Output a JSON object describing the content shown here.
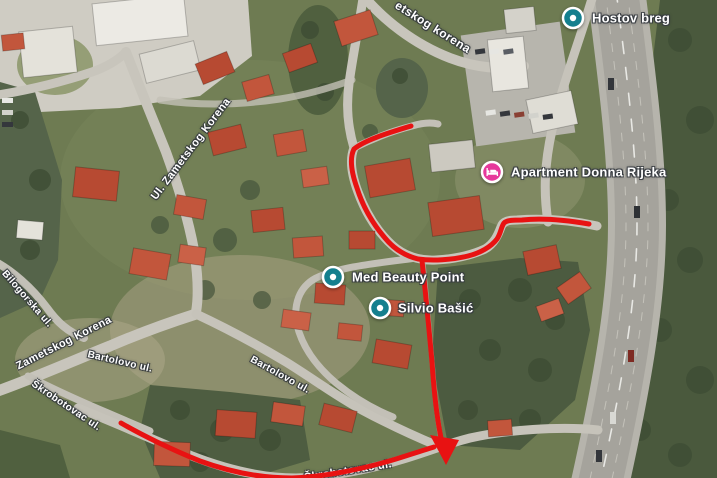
{
  "map": {
    "pois": [
      {
        "label": "Hostov breg",
        "type": "place",
        "pin_color": "#147f8e"
      },
      {
        "label": "Apartment Donna Rijeka",
        "type": "lodging",
        "pin_color": "#e6399b"
      },
      {
        "label": "Med Beauty Point",
        "type": "place",
        "pin_color": "#147f8e"
      },
      {
        "label": "Silvio Bašić",
        "type": "place",
        "pin_color": "#147f8e"
      }
    ],
    "street_labels": [
      "etskog korena",
      "Ul. Zametskog Korena",
      "Bilogorska ul.",
      "Zametskog Korena",
      "Bartolovo ul.",
      "Škrobotovac ul.",
      "Bartolovo ul.",
      "Škrobotovac ul."
    ],
    "route": {
      "color": "#e81212"
    }
  }
}
